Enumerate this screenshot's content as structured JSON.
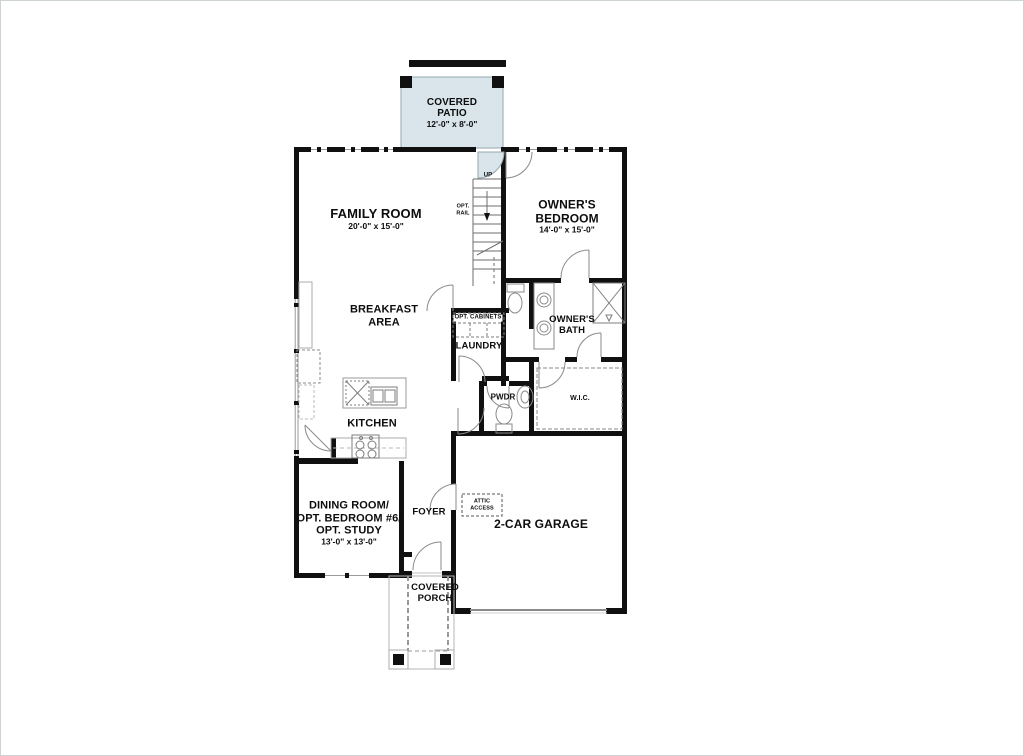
{
  "plan": {
    "rooms": {
      "covered_patio": {
        "lines": [
          "COVERED",
          "PATIO"
        ],
        "dims": "12'-0\" x 8'-0\""
      },
      "family_room": {
        "lines": [
          "FAMILY ROOM"
        ],
        "dims": "20'-0\" x 15'-0\""
      },
      "owners_bedroom": {
        "lines": [
          "OWNER'S",
          "BEDROOM"
        ],
        "dims": "14'-0\" x 15'-0\""
      },
      "breakfast_area": {
        "lines": [
          "BREAKFAST",
          "AREA"
        ]
      },
      "kitchen": {
        "lines": [
          "KITCHEN"
        ]
      },
      "laundry": {
        "lines": [
          "LAUNDRY"
        ]
      },
      "owners_bath": {
        "lines": [
          "OWNER'S",
          "BATH"
        ]
      },
      "pwdr": {
        "lines": [
          "PWDR"
        ]
      },
      "wic": {
        "lines": [
          "W.I.C."
        ]
      },
      "dining_room": {
        "lines": [
          "DINING ROOM/",
          "OPT. BEDROOM #6/",
          "OPT. STUDY"
        ],
        "dims": "13'-0\" x 13'-0\""
      },
      "foyer": {
        "lines": [
          "FOYER"
        ]
      },
      "garage": {
        "lines": [
          "2-CAR GARAGE"
        ]
      },
      "covered_porch": {
        "lines": [
          "COVERED",
          "PORCH"
        ]
      }
    },
    "annotations": {
      "up": "UP",
      "opt_rail": [
        "OPT.",
        "RAIL"
      ],
      "opt_cabinets": "OPT. CABINETS",
      "attic_access": [
        "ATTIC",
        "ACCESS"
      ]
    },
    "colors": {
      "patio_fill": "#d9e5ea",
      "wall": "#101010",
      "fixture_line": "#8a8a8a",
      "porch_line": "#b5b5b5"
    }
  }
}
